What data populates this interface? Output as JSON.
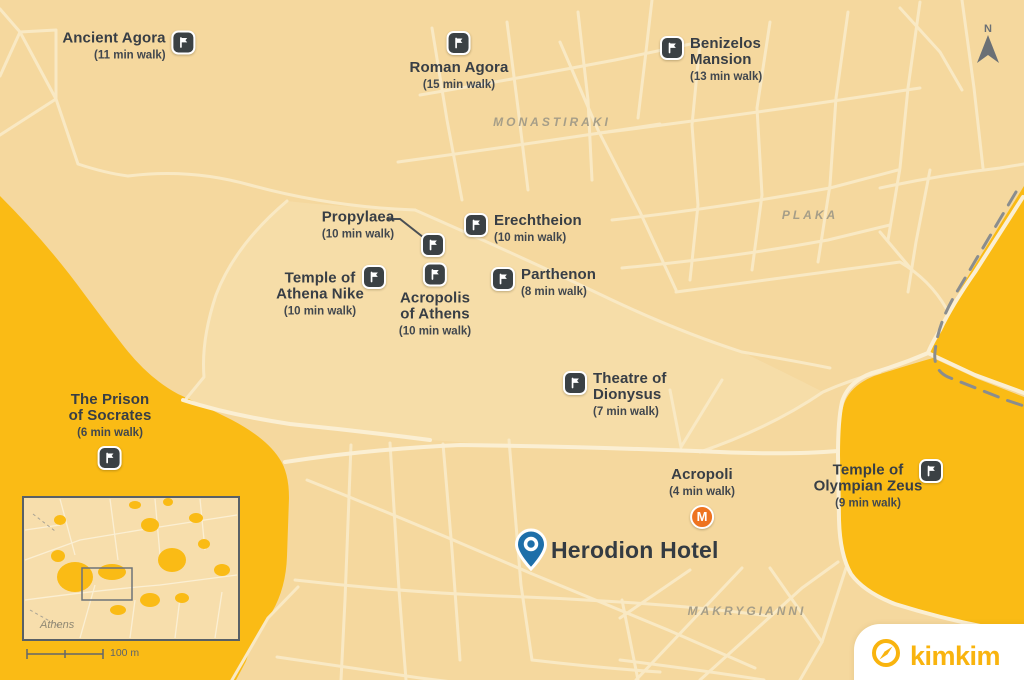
{
  "map": {
    "title": "Walking map around Herodion Hotel, Athens",
    "areas": {
      "monastiraki": "MONASTIRAKI",
      "plaka": "PLAKA",
      "makrygianni": "MAKRYGIANNI"
    },
    "pois": {
      "ancient_agora": {
        "name": "Ancient Agora",
        "walk": "(11 min walk)"
      },
      "roman_agora": {
        "name": "Roman Agora",
        "walk": "(15 min walk)"
      },
      "benizelos": {
        "name": "Benizelos\nMansion",
        "walk": "(13 min walk)"
      },
      "propylaea": {
        "name": "Propylaea",
        "walk": "(10 min walk)"
      },
      "erechtheion": {
        "name": "Erechtheion",
        "walk": "(10 min walk)"
      },
      "athena_nike": {
        "name": "Temple of\nAthena Nike",
        "walk": "(10 min walk)"
      },
      "acropolis": {
        "name": "Acropolis\nof Athens",
        "walk": "(10 min walk)"
      },
      "parthenon": {
        "name": "Parthenon",
        "walk": "(8 min walk)"
      },
      "theatre": {
        "name": "Theatre of\nDionysus",
        "walk": "(7 min walk)"
      },
      "prison": {
        "name": "The Prison\nof Socrates",
        "walk": "(6 min walk)"
      },
      "olympian_zeus": {
        "name": "Temple of\nOlympian Zeus",
        "walk": "(9 min walk)"
      }
    },
    "metro": {
      "station": "Acropoli",
      "walk": "(4 min walk)",
      "symbol": "M"
    },
    "hotel": {
      "name": "Herodion Hotel"
    },
    "compass": {
      "north": "N"
    },
    "inset": {
      "city": "Athens",
      "scale": "100 m"
    },
    "brand": {
      "name": "kimkim"
    },
    "colors": {
      "base": "#F5D89E",
      "park_gold": "#FABB15",
      "road": "#F9E9C4",
      "label_dark": "#383E45",
      "area_gray": "#A69E88",
      "metro_orange": "#EE7320",
      "pin_blue": "#1E6FA9",
      "brand_gold": "#F9B40E"
    }
  }
}
